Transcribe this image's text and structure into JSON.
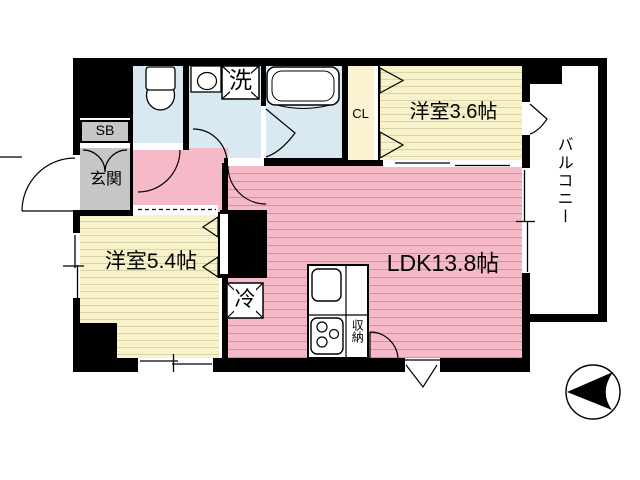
{
  "plan": {
    "type": "apartment-floorplan",
    "labels": {
      "ldk": "LDK13.8帖",
      "western_room_3_6": "洋室3.6帖",
      "western_room_5_4": "洋室5.4帖",
      "balcony": "バルコニー",
      "entrance": "玄関",
      "shoe_box": "SB",
      "closet_upper": "CL",
      "closet_lower": "CL",
      "washing_machine": "洗",
      "refrigerator": "冷",
      "kitchen_storage": "収納"
    },
    "colors": {
      "ldk_pink": "#f6b9c8",
      "ldk_pink_stripe": "#c993a4",
      "room_yellow": "#f8f2ca",
      "room_yellow_stripe": "#dbd3ac",
      "wet_area_blue": "#d8e9f1",
      "entrance_gray": "#c6c6c6",
      "closet_cream": "#faf2d0",
      "wall_black": "#000000"
    }
  }
}
